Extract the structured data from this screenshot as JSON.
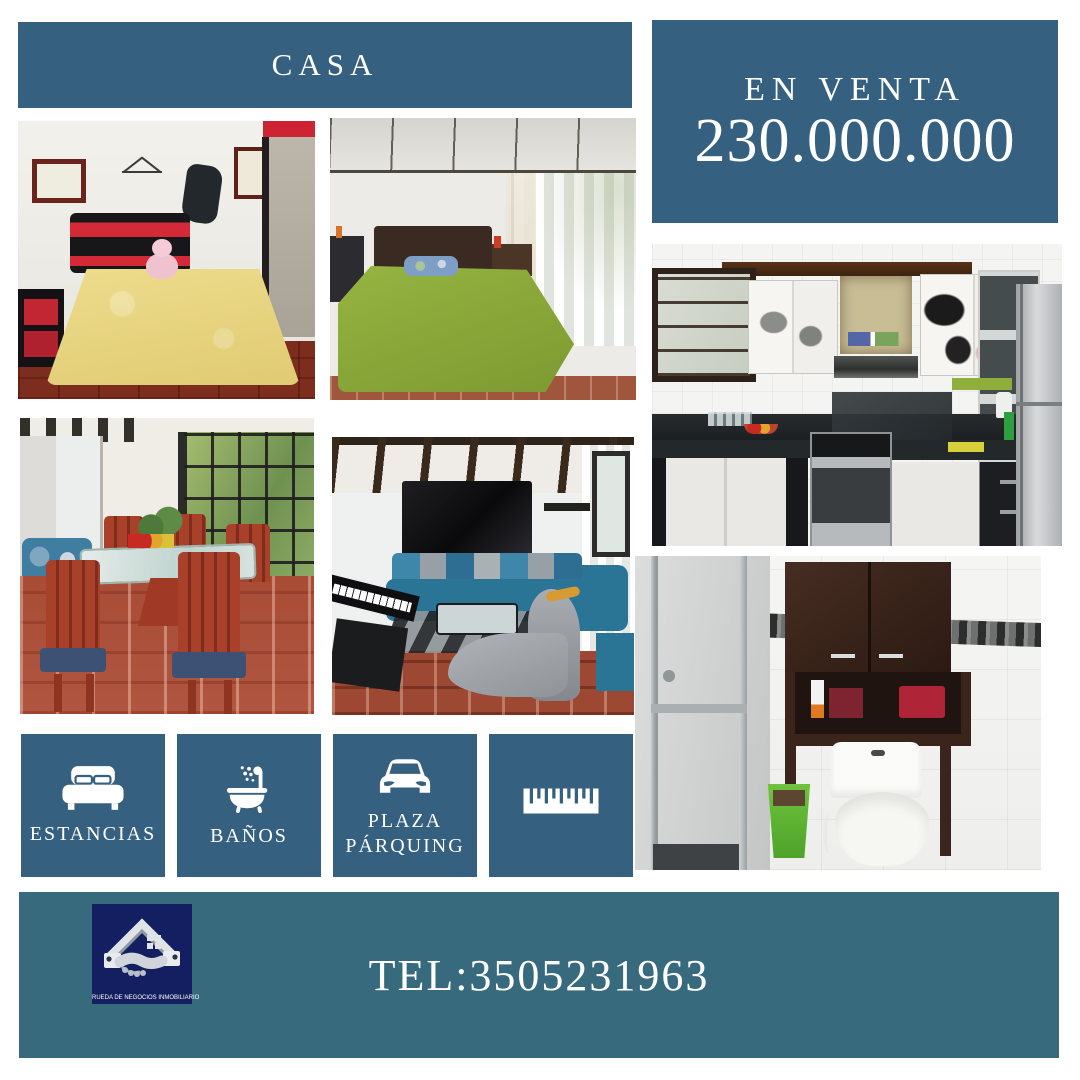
{
  "palette": {
    "primary_blue": "#35607f",
    "footer_teal": "#366a7c",
    "logo_navy": "#131f60",
    "background": "#ffffff",
    "text_on_blue": "#ffffff"
  },
  "header": {
    "title": "CASA"
  },
  "price_box": {
    "label": "EN VENTA",
    "price": "230.000.000"
  },
  "photos": [
    {
      "id": "bedroom-1",
      "description": "bedroom with red and black bed frame and yellow bedspread"
    },
    {
      "id": "bedroom-2",
      "description": "bedroom with green bedspread and window curtains"
    },
    {
      "id": "dining-room",
      "description": "dining room with wooden chairs and glass table"
    },
    {
      "id": "living-room",
      "description": "living room with blue sectional sofa, TV and keyboard"
    },
    {
      "id": "kitchen",
      "description": "kitchen with cow print cabinets, stove and fridge"
    },
    {
      "id": "bathroom",
      "description": "bathroom with shower, cabinet and toilet"
    }
  ],
  "features": [
    {
      "icon": "bed-icon",
      "label": "ESTANCIAS"
    },
    {
      "icon": "bathtub-shower-icon",
      "label": "BAÑOS"
    },
    {
      "icon": "car-icon",
      "label": "PLAZA PÁRQUING"
    },
    {
      "icon": "ruler-icon",
      "label": ""
    }
  ],
  "footer": {
    "phone": "TEL:3505231963",
    "logo_caption": "RUEDA DE NEGOCIOS INMOBILIARIO"
  }
}
